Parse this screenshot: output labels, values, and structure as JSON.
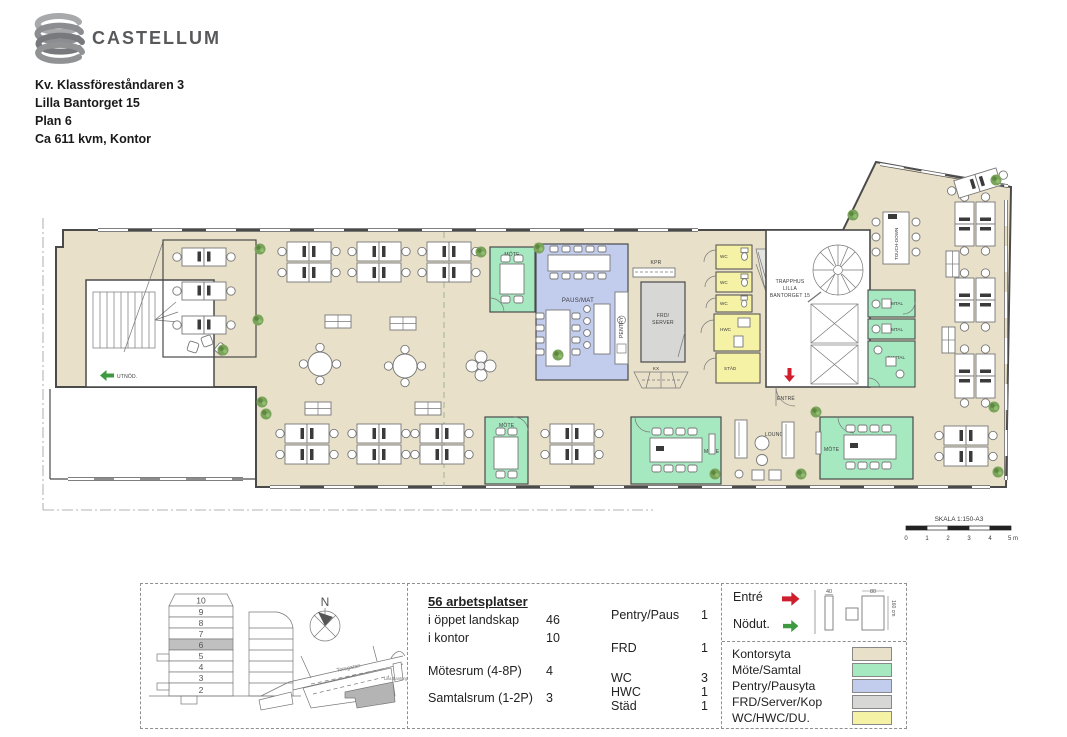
{
  "header": {
    "brand": "CASTELLUM",
    "project": "Kv. Klassföreståndaren 3",
    "address": "Lilla Bantorget 15",
    "floor": "Plan 6",
    "area": "Ca 611 kvm, Kontor"
  },
  "plan": {
    "labels": {
      "mote_small_top": "MÖTE",
      "paus_mat": "PAUS/MAT",
      "pentry": "PENTRY",
      "kpr": "KPR",
      "frd_line1": "FRD/",
      "frd_line2": "SERVER",
      "kx": "KX",
      "wc": "WC",
      "hwc": "HWC",
      "stad": "STÄD",
      "trapphus_line1": "TRAPPHUS",
      "trapphus_line2": "LILLA",
      "trapphus_line3": "BANTORGET 15",
      "entre": "ENTRÉ",
      "utnod": "UTNÖD.",
      "lounge": "LOUNGE",
      "mote_small_bottom": "MÖTE",
      "mote_large_1": "MÖTE",
      "mote_large_2": "MÖTE",
      "samtal_1": "SAMTAL",
      "samtal_2": "SAMTAL",
      "samtal_3": "SAMTAL",
      "touchdown": "TOUCH-DOWN"
    }
  },
  "scalebar": {
    "label": "SKALA 1:150-A3",
    "ticks": [
      "0",
      "1",
      "2",
      "3",
      "4",
      "5 m"
    ]
  },
  "overview": {
    "floors": [
      "10",
      "9",
      "8",
      "7",
      "6",
      "5",
      "4",
      "3",
      "2"
    ],
    "highlighted_floor": "6",
    "compass": "N",
    "street": "Torsgatan",
    "place": "Lilla Bantorget"
  },
  "stats": {
    "title": "56 arbetsplatser",
    "left": [
      {
        "label": "i öppet landskap",
        "value": "46"
      },
      {
        "label": "i kontor",
        "value": "10"
      },
      {
        "label": "Mötesrum (4-8P)",
        "value": "4"
      },
      {
        "label": "Samtalsrum (1-2P)",
        "value": "3"
      }
    ],
    "right": [
      {
        "label": "Pentry/Paus",
        "value": "1"
      },
      {
        "label": "FRD",
        "value": "1"
      },
      {
        "label": "WC",
        "value": "3"
      },
      {
        "label": "HWC",
        "value": "1"
      },
      {
        "label": "Städ",
        "value": "1"
      }
    ]
  },
  "legend": {
    "entre": "Entré",
    "nodut": "Nödut.",
    "dims": {
      "small": "40",
      "large": "80",
      "depth": "160 cm"
    },
    "areas": [
      {
        "label": "Kontorsyta"
      },
      {
        "label": "Möte/Samtal"
      },
      {
        "label": "Pentry/Pausyta"
      },
      {
        "label": "FRD/Server/Kop"
      },
      {
        "label": "WC/HWC/DU."
      }
    ]
  },
  "colors": {
    "kontorsyta": "#e8e0c9",
    "mote_samtal": "#a6e9c1",
    "pentry_paus": "#c2cdee",
    "frd_server": "#d7d7d5",
    "wc": "#f6f2a5",
    "entre_arrow": "#cf1f2d",
    "nodut_arrow": "#3d9a41"
  }
}
